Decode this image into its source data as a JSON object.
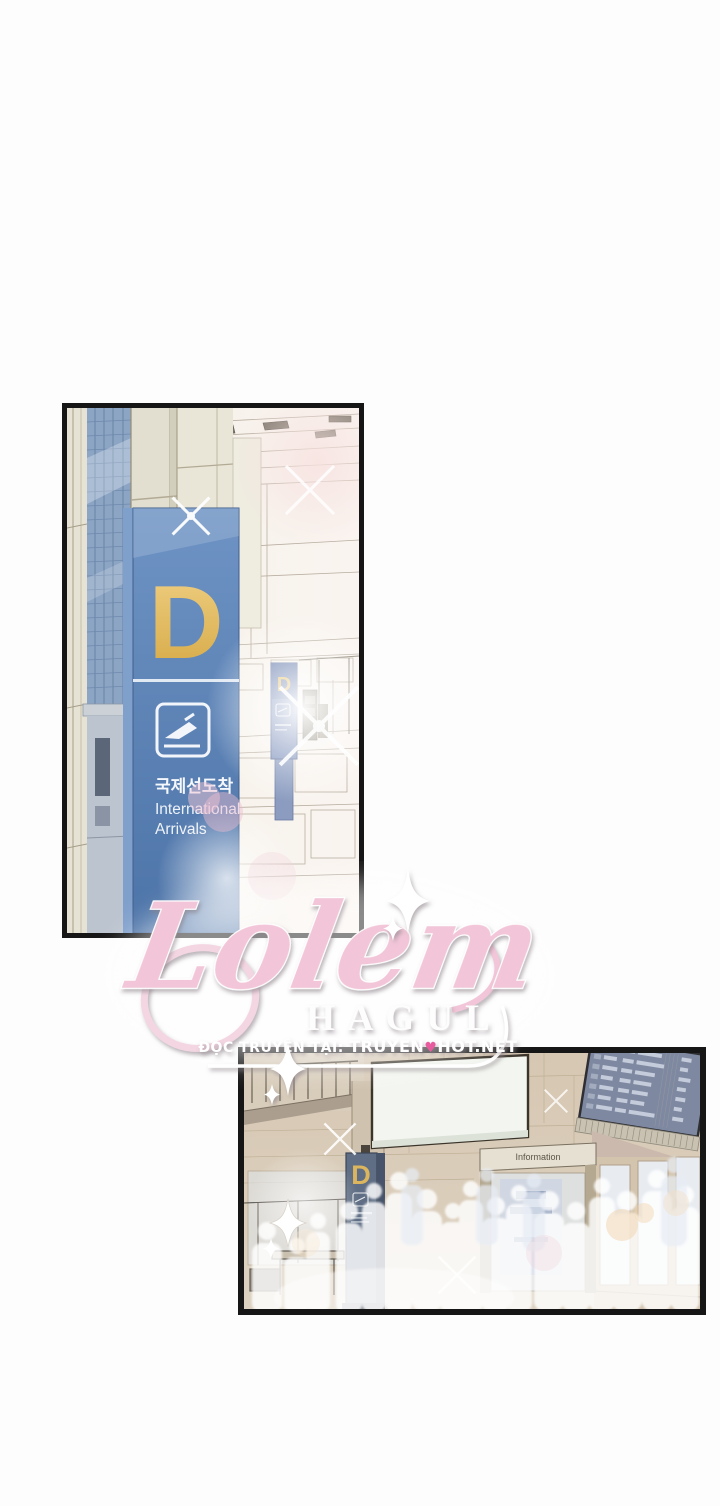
{
  "watermark": {
    "logo": "Lolem",
    "subtitle": "HAGUL",
    "credit_prefix": "ĐỌC TRUYỆN TẠI:",
    "site_name_left": "TRUYEN",
    "site_heart": "♥",
    "site_name_right": "HOT.NET"
  },
  "panel_top": {
    "sign": {
      "zone_letter": "D",
      "korean_label": "국제선도착",
      "english_label_line1": "International",
      "english_label_line2": "Arrivals"
    },
    "distant_sign": {
      "zone_letter": "D"
    }
  },
  "panel_bottom": {
    "pillar_sign": {
      "zone_letter": "D"
    },
    "info_sign_label": "Information"
  },
  "colors": {
    "sign_blue": "#5580b4",
    "zone_letter_gold": "#e7bf63",
    "logo_pink": "#f2c6d8",
    "heart_pink": "#e75c9e",
    "pillar_slate": "#5f6e84"
  }
}
